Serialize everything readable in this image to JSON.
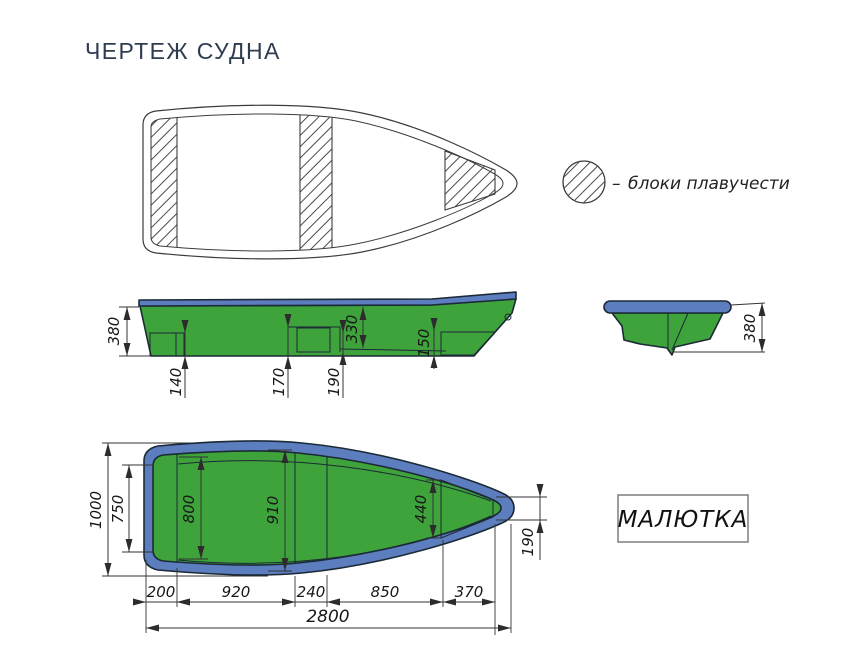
{
  "title": "ЧЕРТЕЖ СУДНА",
  "legend": {
    "dash": "–",
    "label": "блоки плавучести"
  },
  "model_plate": {
    "label": "МАЛЮТКА"
  },
  "colors": {
    "hull_green": "#3FA33C",
    "block_cyan": "#4CC5D7",
    "gunwale_blue": "#5C7DBE",
    "outline_dark": "#1B2A36",
    "drawing_line": "#3C3C3C",
    "title_text": "#2E3C50"
  },
  "side_view": {
    "depth": "380",
    "stern_block_height": "140",
    "mid_block_height": "170",
    "step_height": "190",
    "inner_depth": "330",
    "bow_block_height": "150"
  },
  "transom_view": {
    "height": "380"
  },
  "plan_view": {
    "beam": "1000",
    "stern_inner_width": "750",
    "width_aft": "800",
    "width_mid": "910",
    "bow_block_width": "440",
    "bow_tip_width": "190",
    "seg_stern": "200",
    "seg_aft": "920",
    "seg_seat": "240",
    "seg_fwd": "850",
    "seg_bow": "370",
    "length_overall": "2800"
  }
}
